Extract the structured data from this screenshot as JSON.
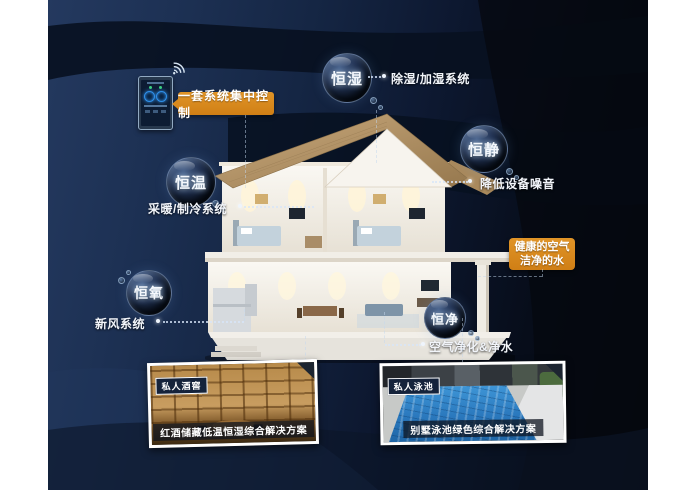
{
  "control": {
    "label": "一套系统集中控制"
  },
  "highlight": {
    "line1": "健康的空气",
    "line2": "洁净的水"
  },
  "features": [
    {
      "name": "恒湿",
      "desc": "除湿/加湿系统"
    },
    {
      "name": "恒静",
      "desc": "降低设备噪音"
    },
    {
      "name": "恒温",
      "desc": "采暖/制冷系统"
    },
    {
      "name": "恒氧",
      "desc": "新风系统"
    },
    {
      "name": "恒净",
      "desc": "空气净化&净水"
    }
  ],
  "cards": [
    {
      "badge": "私人酒窖",
      "caption": "红酒储藏低温恒湿综合解决方案"
    },
    {
      "badge": "私人泳池",
      "caption": "别墅泳池绿色综合解决方案"
    }
  ],
  "icons": {
    "wifi": "wifi-icon",
    "phone": "smart-control-app"
  },
  "colors": {
    "accent_orange": "#DB8A20",
    "background_navy": "#16253F",
    "bubble_rim": "#AFC9E8",
    "card_border": "#FFFFFF"
  }
}
